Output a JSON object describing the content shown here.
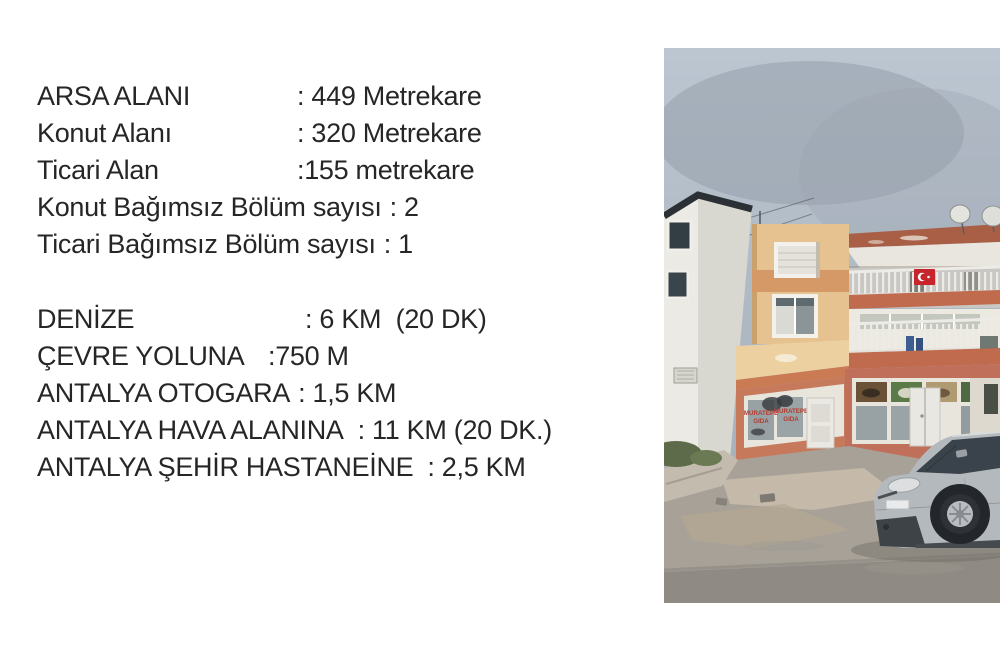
{
  "info": {
    "text_color": "#262626",
    "block1": [
      {
        "label": "ARSA ALANI",
        "value": ": 449 Metrekare"
      },
      {
        "label": "Konut Alanı",
        "value": ": 320 Metrekare"
      },
      {
        "label": "Ticari Alan",
        "value": ":155 metrekare"
      },
      {
        "label": "Konut Bağımsız Bölüm sayısı",
        "value": ": 2"
      },
      {
        "label": "Ticari Bağımsız Bölüm sayısı",
        "value": ": 1"
      }
    ],
    "block2": [
      {
        "label": "DENİZE",
        "value": ": 6 KM  (20 DK)"
      },
      {
        "label": "ÇEVRE YOLUNA",
        "value": ":750 M"
      },
      {
        "label": "ANTALYA OTOGARA",
        "value": ": 1,5 KM"
      },
      {
        "label": "ANTALYA HAVA ALANINA",
        "value": ": 11 KM (20 DK.)"
      },
      {
        "label": "ANTALYA ŞEHİR HASTANEİNE",
        "value": ": 2,5 KM"
      }
    ]
  },
  "photo": {
    "shop_sign": {
      "line1": "MURATEPE",
      "line2": "GIDA"
    },
    "colors": {
      "sky_top": "#bcc6d1",
      "sky_bottom": "#a6b0bb",
      "cloud": "#929ca8",
      "white_bldg_front": "#eceae5",
      "white_bldg_side": "#d8d7d0",
      "bldg_trim": "#2b3034",
      "wall_beige": "#e7c291",
      "band_orange": "#d59968",
      "fascia": "#ecd0a0",
      "fascia_stripe": "#ca7b53",
      "slab_terracotta": "#a95f46",
      "balcony_slab": "#c06a4e",
      "storefront": "#c77a5b",
      "window_frame": "#e8e5dd",
      "glass": "#98a2a4",
      "sign_red": "#b23a2e",
      "flag_red": "#c8242c",
      "railing": "#edebe6",
      "road": "#a7a198",
      "asphalt": "#8f8b84",
      "dirt": "#c6bcab",
      "sidewalk": "#c3bcae",
      "car_body": "#b4b9bd",
      "car_glass": "#3a434b",
      "car_dark": "#3e4347",
      "greenery": "#5d6b4a",
      "blue_jugs": "#3c5e92"
    }
  }
}
